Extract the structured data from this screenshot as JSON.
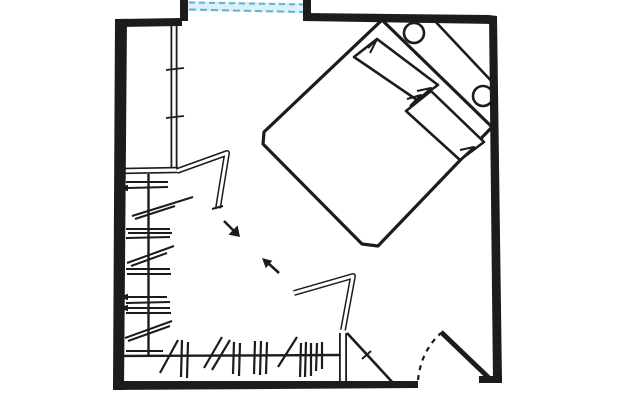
{
  "canvas": {
    "width": 642,
    "height": 400
  },
  "colors": {
    "ink": "#1c1c1c",
    "paper": "#ffffff",
    "glass": "#ddeff7",
    "window_dash": "#5fb3d4"
  },
  "plan": {
    "description": "hand-drawn bedroom floor plan sketch: window top, bed rotated 45 degrees upper right with two pillows and two round bedside objects, L-shaped closet with hanging-clothes hatches on left and bottom walls, two open closet panels, circulation arrows in the middle, swing door bottom right",
    "layers": [
      {
        "name": "window",
        "shapes": [
          {
            "k": "fill",
            "f": "glass",
            "pts": [
              "188,1",
              "304,3",
              "304,13",
              "188,11"
            ]
          },
          {
            "k": "line",
            "p": [
              189,
              2.5,
              303,
              4.5
            ],
            "w": 2,
            "c": "window_dash",
            "dash": "6 4"
          },
          {
            "k": "line",
            "p": [
              189,
              9.5,
              303,
              12
            ],
            "w": 2,
            "c": "window_dash",
            "dash": "7 4"
          }
        ]
      },
      {
        "name": "closet-partition-wall",
        "shapes": [
          {
            "k": "pline",
            "pts": [
              "174,26",
              "174,170"
            ],
            "w": 7
          },
          {
            "k": "pline",
            "pts": [
              "174,26",
              "174,170"
            ],
            "w": 3.4,
            "c": "paper"
          },
          {
            "k": "line",
            "p": [
              166,
              70,
              184,
              68
            ],
            "w": 1.8
          },
          {
            "k": "line",
            "p": [
              166,
              118,
              184,
              116
            ],
            "w": 1.8
          }
        ]
      },
      {
        "name": "closet-shelf",
        "shapes": [
          {
            "k": "pline",
            "pts": [
              "121,171",
              "178,170"
            ],
            "w": 6.5
          },
          {
            "k": "pline",
            "pts": [
              "121,171",
              "178,170"
            ],
            "w": 3.2,
            "c": "paper"
          }
        ]
      },
      {
        "name": "closet-left-hanging-clothes",
        "shapes": [
          {
            "k": "line",
            "p": [
              148.5,
              174,
              148.5,
              357
            ],
            "w": 2.4
          },
          {
            "k": "line",
            "p": [
              126,
              182,
              168,
              182
            ],
            "w": 2
          },
          {
            "k": "line",
            "p": [
              128,
              188,
              168,
              187
            ],
            "w": 2
          },
          {
            "k": "fill",
            "pts": [
              "119,188",
              "128,184.8",
              "128,191.2"
            ]
          },
          {
            "k": "line",
            "p": [
              132,
              216,
              193,
              197
            ],
            "w": 2
          },
          {
            "k": "line",
            "p": [
              135,
              219,
              175,
              206
            ],
            "w": 2
          },
          {
            "k": "line",
            "p": [
              126,
              229,
              170,
              229
            ],
            "w": 2
          },
          {
            "k": "line",
            "p": [
              128,
              233,
              172,
              233
            ],
            "w": 2
          },
          {
            "k": "line",
            "p": [
              126,
              238,
              170,
              237
            ],
            "w": 2
          },
          {
            "k": "line",
            "p": [
              127,
              263,
              174,
              246
            ],
            "w": 2
          },
          {
            "k": "line",
            "p": [
              131,
              266,
              167,
              253
            ],
            "w": 2
          },
          {
            "k": "line",
            "p": [
              126,
              269,
              170,
              269
            ],
            "w": 2
          },
          {
            "k": "line",
            "p": [
              127,
              274,
              171,
              274
            ],
            "w": 2
          },
          {
            "k": "line",
            "p": [
              128,
              297,
              167,
              297
            ],
            "w": 2
          },
          {
            "k": "fill",
            "pts": [
              "119,297",
              "128,293.8",
              "128,300.2"
            ]
          },
          {
            "k": "line",
            "p": [
              126,
              303,
              170,
              302
            ],
            "w": 2
          },
          {
            "k": "line",
            "p": [
              128,
              308,
              170,
              308
            ],
            "w": 2
          },
          {
            "k": "fill",
            "pts": [
              "119,308",
              "128,304.8",
              "128,311.2"
            ]
          },
          {
            "k": "line",
            "p": [
              126,
              313,
              171,
              313
            ],
            "w": 2
          },
          {
            "k": "line",
            "p": [
              125,
              338,
              172,
              321
            ],
            "w": 2
          },
          {
            "k": "line",
            "p": [
              128,
              341,
              170,
              326
            ],
            "w": 2
          },
          {
            "k": "line",
            "p": [
              126,
              351,
              163,
              351
            ],
            "w": 2
          }
        ]
      },
      {
        "name": "closet-bottom-hanging-clothes",
        "shapes": [
          {
            "k": "line",
            "p": [
              123,
              356,
              341,
              355
            ],
            "w": 2.4
          },
          {
            "k": "line",
            "p": [
              160,
              373,
              178,
              340
            ],
            "w": 2.2
          },
          {
            "k": "line",
            "p": [
              182,
              340,
              181,
              377
            ],
            "w": 2.2
          },
          {
            "k": "line",
            "p": [
              188,
              342,
              187,
              378
            ],
            "w": 2.2
          },
          {
            "k": "line",
            "p": [
              204,
              368,
              222,
              337
            ],
            "w": 2.2
          },
          {
            "k": "line",
            "p": [
              212,
              370,
              230,
              340
            ],
            "w": 2.2
          },
          {
            "k": "line",
            "p": [
              234,
              342,
              233,
              374
            ],
            "w": 2.2
          },
          {
            "k": "line",
            "p": [
              240,
              343,
              239,
              376
            ],
            "w": 2.2
          },
          {
            "k": "line",
            "p": [
              255,
              341,
              254,
              374
            ],
            "w": 2.2
          },
          {
            "k": "line",
            "p": [
              261,
              341,
              260,
              375
            ],
            "w": 2.2
          },
          {
            "k": "line",
            "p": [
              267,
              342,
              266,
              374
            ],
            "w": 2.2
          },
          {
            "k": "line",
            "p": [
              278,
              367,
              297,
              337
            ],
            "w": 2.2
          },
          {
            "k": "line",
            "p": [
              301,
              343,
              300,
              377
            ],
            "w": 2.2
          },
          {
            "k": "line",
            "p": [
              306,
              342,
              305,
              377
            ],
            "w": 2.2
          },
          {
            "k": "line",
            "p": [
              311,
              343,
              311,
              376
            ],
            "w": 2.2
          },
          {
            "k": "line",
            "p": [
              317,
              343,
              316,
              371
            ],
            "w": 2.2
          },
          {
            "k": "line",
            "p": [
              322,
              342,
              322,
              369
            ],
            "w": 2.2
          }
        ]
      },
      {
        "name": "open-closet-panels",
        "shapes": [
          {
            "k": "pline",
            "pts": [
              "177,171",
              "227,153",
              "218,208"
            ],
            "w": 6
          },
          {
            "k": "pline",
            "pts": [
              "177,171",
              "227,153",
              "218,208"
            ],
            "w": 3,
            "c": "paper"
          },
          {
            "k": "line",
            "p": [
              212,
              209,
              223,
              206
            ],
            "w": 2
          },
          {
            "k": "pline",
            "pts": [
              "294,293",
              "353,276",
              "343,330"
            ],
            "w": 6
          },
          {
            "k": "pline",
            "pts": [
              "294,293",
              "353,276",
              "343,330"
            ],
            "w": 3,
            "c": "paper"
          }
        ]
      },
      {
        "name": "door-side-partition",
        "shapes": [
          {
            "k": "pline",
            "pts": [
              "343,333",
              "343,384"
            ],
            "w": 8
          },
          {
            "k": "pline",
            "pts": [
              "343,333",
              "343,384"
            ],
            "w": 4.4,
            "c": "paper"
          },
          {
            "k": "line",
            "p": [
              347,
              333,
              394,
              384
            ],
            "w": 2.6
          },
          {
            "k": "line",
            "p": [
              362,
              359,
              371,
              351
            ],
            "w": 2
          }
        ]
      },
      {
        "name": "entry-door",
        "shapes": [
          {
            "k": "path",
            "d": "M418,380 Q421,351 441,333",
            "w": 2.2,
            "dash": "5 5"
          },
          {
            "k": "line",
            "p": [
              441,
              332,
              489,
              378
            ],
            "w": 5
          }
        ]
      },
      {
        "name": "bed",
        "shapes": [
          {
            "k": "path",
            "d": "M382,20 L492,127 L378,246 L362,244 L263,144 L264,132 Z",
            "w": 3.2
          },
          {
            "k": "line",
            "p": [
              433,
              19,
              496,
              86
            ],
            "w": 2.6
          }
        ]
      },
      {
        "name": "bedside-lamps",
        "shapes": [
          {
            "k": "circle",
            "cx": 414,
            "cy": 33,
            "r": 10,
            "w": 2.6
          },
          {
            "k": "circle",
            "cx": 483,
            "cy": 96,
            "r": 10,
            "w": 2.6
          }
        ]
      },
      {
        "name": "pillows",
        "shapes": [
          {
            "k": "path",
            "d": "M377,39 L354,57 L417,100 L438,85 Z",
            "w": 2.6,
            "f": "paper"
          },
          {
            "k": "pline",
            "pts": [
              "368,48",
              "377,39",
              "370,53"
            ],
            "w": 2
          },
          {
            "k": "pline",
            "pts": [
              "419,99",
              "431,88",
              "417,91"
            ],
            "w": 2
          },
          {
            "k": "path",
            "d": "M431,91 L406,111 L460,160 L484,142 Z",
            "w": 2.6,
            "f": "paper"
          },
          {
            "k": "pline",
            "pts": [
              "410,106",
              "421,95",
              "407,99"
            ],
            "w": 2
          },
          {
            "k": "pline",
            "pts": [
              "462,158",
              "474,147",
              "460,150"
            ],
            "w": 2
          }
        ]
      },
      {
        "name": "walk-arrows",
        "shapes": [
          {
            "k": "line",
            "p": [
              224,
              221,
              234,
              231
            ],
            "w": 2.6
          },
          {
            "k": "fill",
            "pts": [
              "240,237",
              "228.4,234.6",
              "237.6,225.4"
            ]
          },
          {
            "k": "line",
            "p": [
              279,
              273,
              268,
              263
            ],
            "w": 2.6
          },
          {
            "k": "fill",
            "pts": [
              "262,258",
              "272.3,260.8",
              "265.8,268.3"
            ]
          }
        ]
      },
      {
        "name": "room-walls",
        "shapes": [
          {
            "k": "fill",
            "pts": [
              "115,19",
              "127,19",
              "124,390",
              "113,390"
            ]
          },
          {
            "k": "fill",
            "pts": [
              "115,19",
              "182,18",
              "182,26",
              "116,27"
            ]
          },
          {
            "k": "fill",
            "pts": [
              "180,0",
              "188,0",
              "188,21",
              "180,21"
            ]
          },
          {
            "k": "fill",
            "pts": [
              "303,0",
              "311,0",
              "311,19",
              "303,19"
            ]
          },
          {
            "k": "fill",
            "pts": [
              "303,13",
              "489,15",
              "496,24",
              "303,21"
            ]
          },
          {
            "k": "fill",
            "pts": [
              "489,15",
              "497,16",
              "502,382",
              "493,382"
            ]
          },
          {
            "k": "fill",
            "pts": [
              "113,381",
              "418,381",
              "418,388",
              "113,390"
            ]
          },
          {
            "k": "fill",
            "pts": [
              "479,376",
              "502,376",
              "502,383",
              "479,383"
            ]
          }
        ]
      }
    ]
  }
}
